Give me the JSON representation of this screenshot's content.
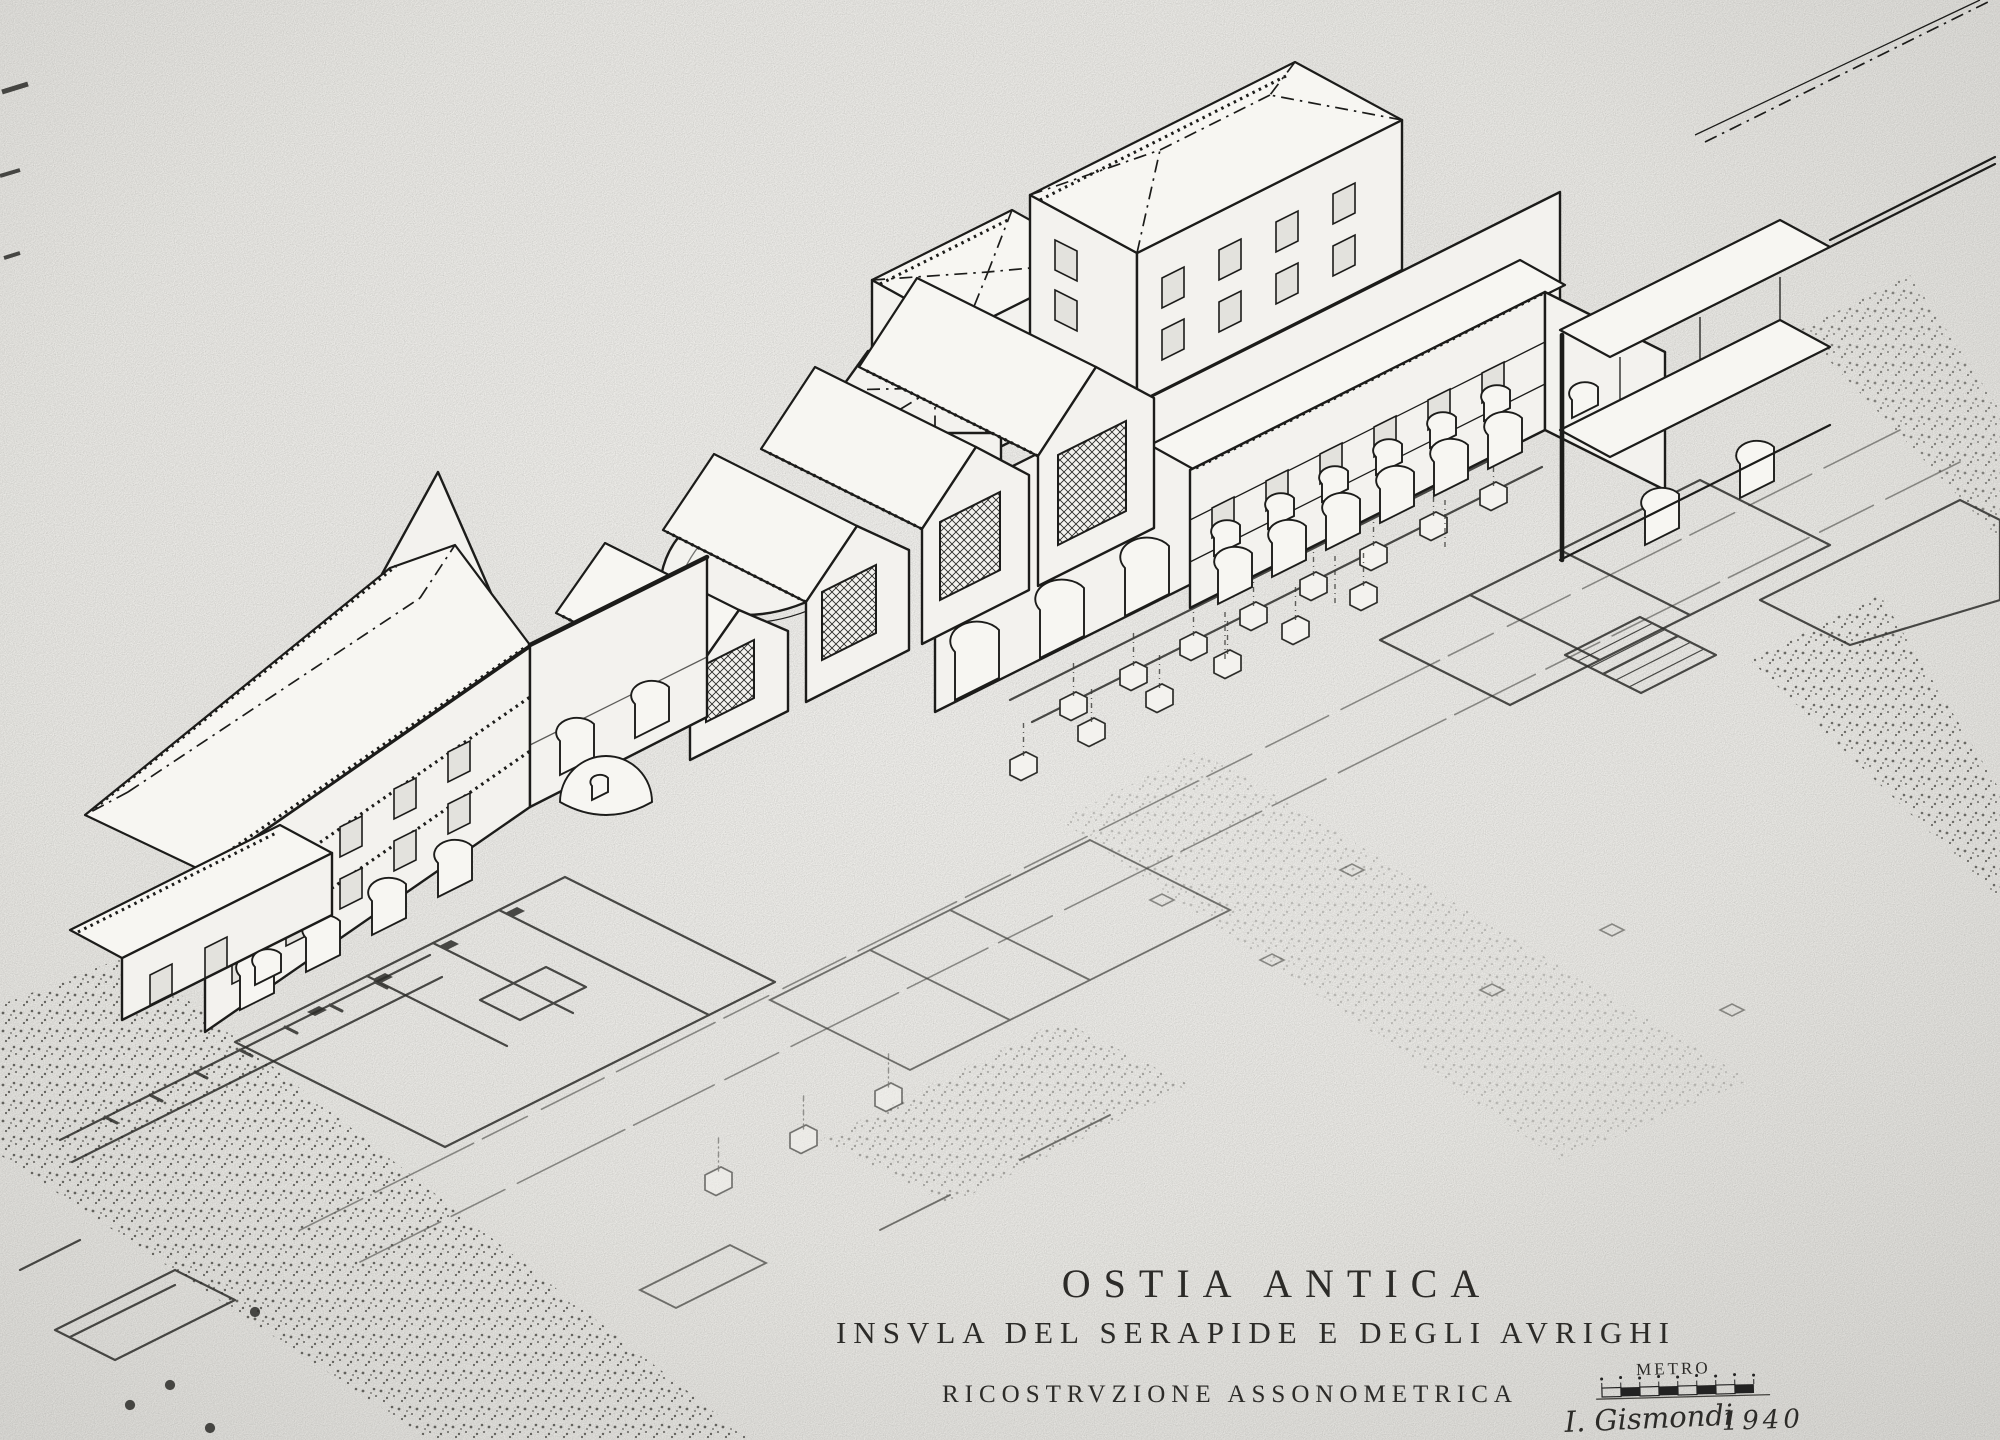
{
  "title_block": {
    "title": "OSTIA ANTICA",
    "subtitle": "INSVLA DEL SERAPIDE E DEGLI AVRIGHI",
    "caption": "RICOSTRVZIONE ASSONOMETRICA",
    "scale_label": "METRO",
    "signature": "I. Gismondi",
    "year": "1940"
  },
  "palette": {
    "paper": "#e9e8e4",
    "ink": "#1c1c1a",
    "faint_ink": "#4c4c48"
  }
}
